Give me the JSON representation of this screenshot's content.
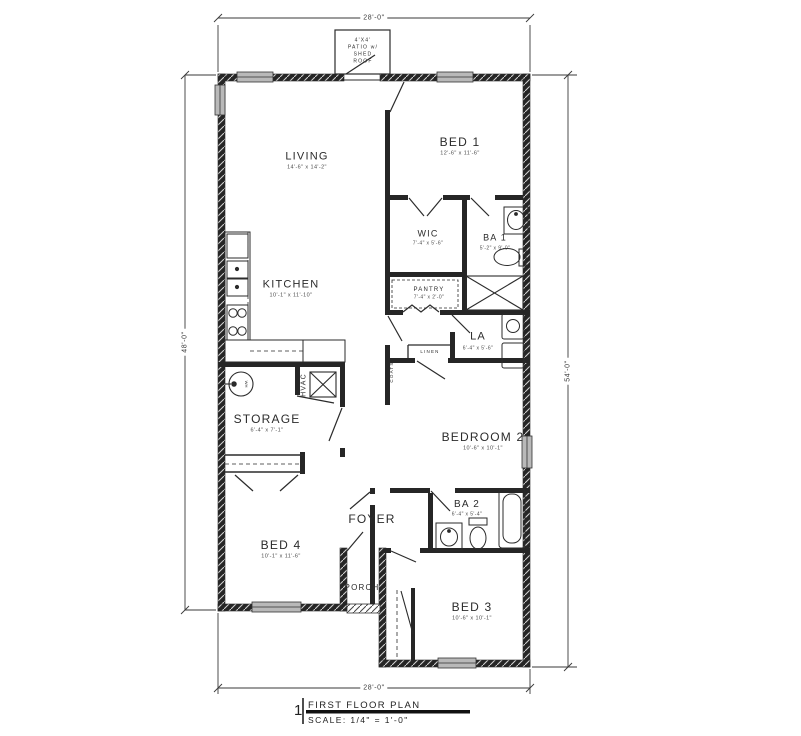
{
  "title_block": {
    "number": "1",
    "title": "FIRST FLOOR PLAN",
    "scale": "SCALE: 1/4\" = 1'-0\""
  },
  "dimensions": {
    "top": "28'-0\"",
    "bottom": "28'-0\"",
    "left": "48'-0\"",
    "right": "54'-0\""
  },
  "patio_label": {
    "line1": "4'X4'",
    "line2": "PATIO w/",
    "line3": "SHED",
    "line4": "ROOF"
  },
  "rooms": {
    "living": {
      "name": "LIVING",
      "dims": "14'-6\" x 14'-2\""
    },
    "kitchen": {
      "name": "KITCHEN",
      "dims": "10'-1\" x 11'-10\""
    },
    "bed1": {
      "name": "BED 1",
      "dims": "12'-6\" x 11'-6\""
    },
    "wic": {
      "name": "WIC",
      "dims": "7'-4\" x 5'-6\""
    },
    "ba1": {
      "name": "BA 1",
      "dims": "5'-2\" x 9'-0\""
    },
    "pantry": {
      "name": "PANTRY",
      "dims": "7'-4\" x 2'-0\""
    },
    "la": {
      "name": "LA",
      "dims": "6'-4\" x 5'-6\""
    },
    "linen": {
      "name": "LINEN"
    },
    "coats": {
      "name": "COATS"
    },
    "hvac": {
      "name": "HVAC"
    },
    "storage": {
      "name": "STORAGE",
      "dims": "6'-4\" x 7'-1\""
    },
    "bedroom2": {
      "name": "BEDROOM 2",
      "dims": "10'-6\" x 10'-1\""
    },
    "ba2": {
      "name": "BA 2",
      "dims": "6'-4\" x 5'-4\""
    },
    "foyer": {
      "name": "FOYER"
    },
    "bed4": {
      "name": "BED 4",
      "dims": "10'-1\" x 11'-6\""
    },
    "porch": {
      "name": "PORCH"
    },
    "bed3": {
      "name": "BED 3",
      "dims": "10'-6\" x 10'-1\""
    }
  },
  "symbols": {
    "water_heater": "WH"
  },
  "colors": {
    "ink": "#2b2b2b",
    "wall": "#262626",
    "window_fill": "#b9b9b9",
    "paper": "#ffffff"
  }
}
